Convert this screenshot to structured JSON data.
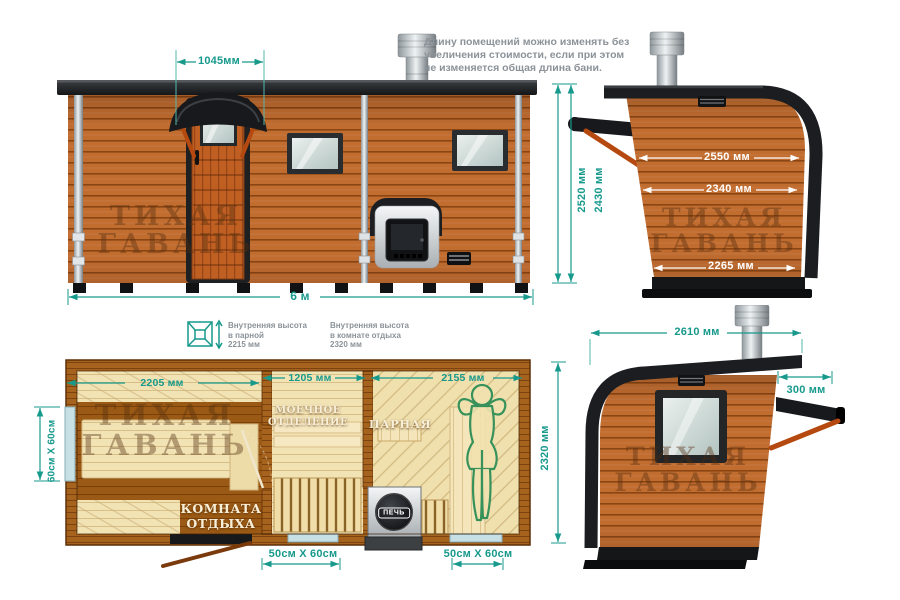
{
  "title_note": "Длину помещений можно изменять без\nувеличения стоимости, если при этом\nне изменяется общая длина бани.",
  "watermark": {
    "line1": "ТИХАЯ",
    "line2": "ГАВАНЬ"
  },
  "colors": {
    "dimension_teal": "#17998c",
    "wood_orange": "#c26d30",
    "roof_black": "#1b1d20",
    "strut_orange": "#b5490f"
  },
  "front_view": {
    "dim_door_width": "1045мм",
    "dim_total_length": "6 м"
  },
  "right_side_view": {
    "dim_height_outer": "2520 мм",
    "dim_height_inner": "2430 мм",
    "dim_width_top": "2550 мм",
    "dim_width_middle": "2340 мм",
    "dim_width_bottom": "2265 мм"
  },
  "left_side_view": {
    "dim_width_top": "2610 мм",
    "dim_eave": "300 мм"
  },
  "floor_plan": {
    "height_note_steam": "Внутренняя высота\nв парной\n2215 мм",
    "height_note_rest": "Внутренняя высота\nв комнате отдыха\n2320 мм",
    "dim_rest_room": "2205 мм",
    "dim_wash_room": "1205 мм",
    "dim_steam_room": "2155 мм",
    "dim_depth": "2320 мм",
    "dim_window_side": "60см Х 60см",
    "dim_window_bottom_1": "50см Х 60см",
    "dim_window_bottom_2": "50см Х 60см",
    "label_rest_room": "КОМНАТА\nОТДЫХА",
    "label_wash_room": "МОЕЧНОЕ\nОТДЕЛЕНИЕ",
    "label_steam_room": "ПАРНАЯ",
    "label_stove": "ПЕЧЬ"
  }
}
